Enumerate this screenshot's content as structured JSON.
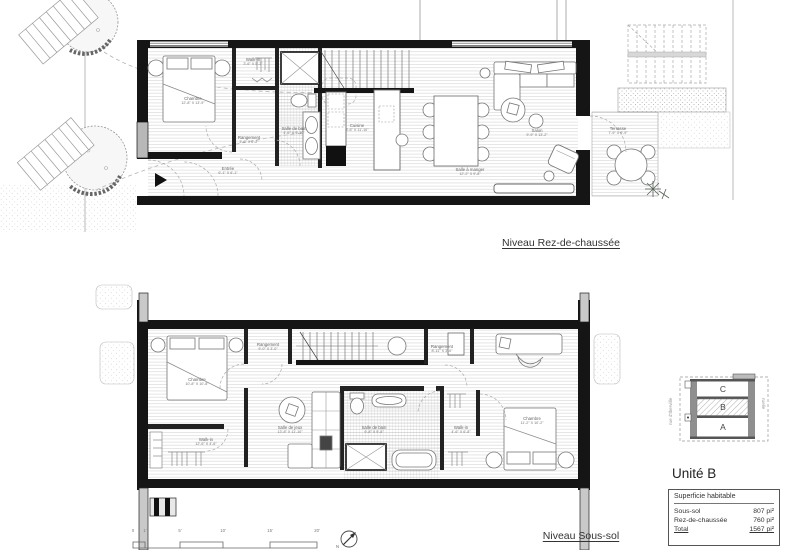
{
  "titles": {
    "ground": "Niveau Rez-de-chaussée",
    "basement": "Niveau Sous-sol"
  },
  "plans": {
    "ground": {
      "rooms": [
        {
          "name": "Chambre",
          "dims": "12'-8\" X 13'-9\""
        },
        {
          "name": "Walk-in",
          "dims": "3'-6\" X 5'-2\""
        },
        {
          "name": "Rangement",
          "dims": "3'-6\" X 6'-2\""
        },
        {
          "name": "Salle de bain",
          "dims": "4'-6\" X 9'-10\""
        },
        {
          "name": "Cuisine",
          "dims": "8'-6\" X 11'-10\""
        },
        {
          "name": "Salle à manger",
          "dims": "12'-2\" X 9'-8\""
        },
        {
          "name": "Salon",
          "dims": "9'-9\" X 13'-2\""
        },
        {
          "name": "Terrasse",
          "dims": "7'-9\" X 9'-9\""
        },
        {
          "name": "Entrée",
          "dims": "6'-1\" X 6'-1\""
        }
      ]
    },
    "basement": {
      "rooms": [
        {
          "name": "Chambre",
          "dims": "10'-8\" X 10'-8\""
        },
        {
          "name": "Rangement",
          "dims": "9'-0\" X 3'-0\""
        },
        {
          "name": "Walk-in",
          "dims": "12'-6\" X 4'-6\""
        },
        {
          "name": "Salle de jeux",
          "dims": "13'-8\" X 11'-10\""
        },
        {
          "name": "Rangement",
          "dims": "8'-11\" X 3'-0\""
        },
        {
          "name": "Salle de bain",
          "dims": "9'-8\" X 9'-8\""
        },
        {
          "name": "Walk-in",
          "dims": "4'-6\" X 6'-8\""
        },
        {
          "name": "Chambre",
          "dims": "11'-2\" X 10'-2\""
        }
      ]
    }
  },
  "scalebar": {
    "labels": [
      "0",
      "1'",
      "5'",
      "10'",
      "15'",
      "20'"
    ],
    "north": "N"
  },
  "keyplan": {
    "units": [
      "C",
      "B",
      "A"
    ],
    "highlighted": "B",
    "street_left": "rue d'Iberville",
    "street_right": "ruelle"
  },
  "info": {
    "title": "Unité B",
    "header": "Superficie habitable",
    "rows": [
      {
        "label": "Sous-sol",
        "value": "807 pi²"
      },
      {
        "label": "Rez-de-chaussée",
        "value": "760 pi²"
      },
      {
        "label": "Total",
        "value": "1567 pi²"
      }
    ]
  },
  "colors": {
    "wall": "#151515",
    "floor_line": "#cccccc",
    "furniture": "#777777",
    "dashed": "#aaaaaa"
  }
}
